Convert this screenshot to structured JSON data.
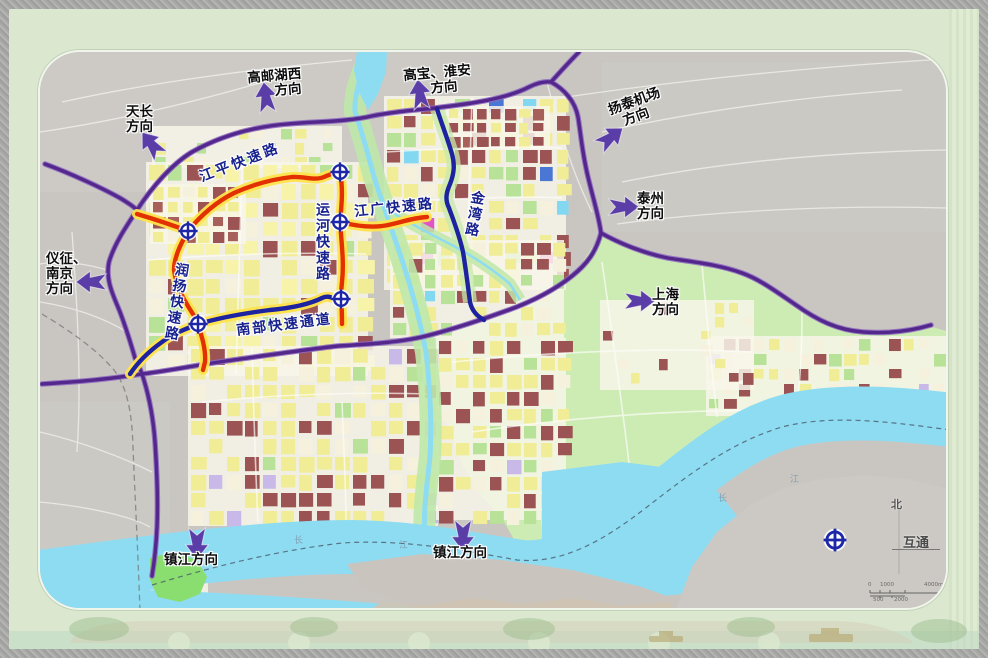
{
  "colors": {
    "ring_road": "#53278c",
    "expressway": "#e33000",
    "expressway_glow": "#ffe34d",
    "artery": "#1c22a0",
    "water": "#8edcf2",
    "road_label": "#18228e",
    "direction_label": "#0d0d0d",
    "arrow": "#5b3da8"
  },
  "direction_labels": {
    "tianchang": {
      "line1": "天长",
      "line2": "方向"
    },
    "gaoyou_lake_west": {
      "line1": "高邮湖西",
      "line2": "方向"
    },
    "gaobao_huaian": {
      "line1": "高宝、淮安",
      "line2": "方向"
    },
    "yangtai_airport": {
      "line1": "扬泰机场",
      "line2": "方向"
    },
    "taizhou": {
      "line1": "泰州",
      "line2": "方向"
    },
    "shanghai": {
      "line1": "上海",
      "line2": "方向"
    },
    "yizheng_nanjing": {
      "line1": "仪征、",
      "line2": "南京",
      "line3": "方向"
    },
    "zhenjiang_west": {
      "line1": "镇江方向"
    },
    "zhenjiang_east": {
      "line1": "镇江方向"
    }
  },
  "road_labels": {
    "jiangping": "江平快速路",
    "jiangguang": "江广快速路",
    "yunhe": "运河快速路",
    "jinwan": "金湾路",
    "runyang": "润扬快速路",
    "nanbu": "南部快速通道"
  },
  "river_labels": {
    "chang1": "长",
    "jiang1": "江",
    "chang2": "长",
    "jiang2": "江"
  },
  "legend": {
    "interchange": "互通",
    "north": "北"
  },
  "scale_bar": {
    "zero": "0",
    "k1": "1000",
    "k4": "4000m",
    "k05": "500",
    "k2": "2000"
  }
}
